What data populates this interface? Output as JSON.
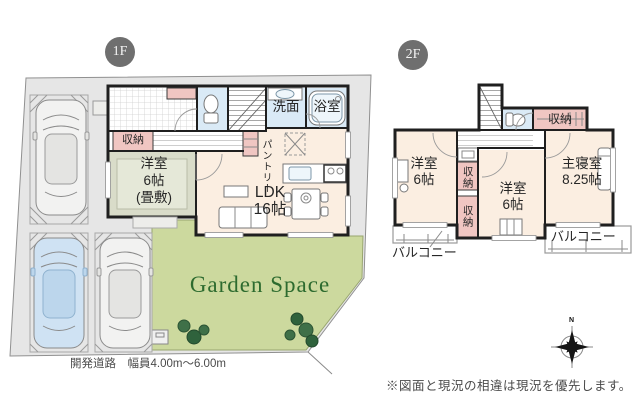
{
  "palette": {
    "wall": "#1f1f1f",
    "room-cream": "#fbeee1",
    "closet-pink": "#f0c6c2",
    "wet-blue": "#daeaf6",
    "tatami-green": "#d9dcc9",
    "tatami-inner": "#e5e8d8",
    "garden-green": "#ccd99e",
    "lot-gray": "#e6e6e6",
    "garden-text": "#2d6b2f",
    "badge": "#6f6f6f",
    "car-blue": "#cfe2f3"
  },
  "floor1": {
    "badge": "1F",
    "closet": "収納",
    "tatami_room": {
      "line1": "洋室",
      "line2": "6帖",
      "line3": "(畳敷)"
    },
    "ldk": {
      "line1": "LDK",
      "line2": "16帖"
    },
    "washroom": "洗面",
    "bathroom": "浴室",
    "pantry": "パントリー",
    "garden": "Garden Space",
    "road": "開発道路　幅員4.00m〜6.00m"
  },
  "floor2": {
    "badge": "2F",
    "bedroom_left": {
      "line1": "洋室",
      "line2": "6帖"
    },
    "closet_top": "収納",
    "closet_mid": "収納",
    "closet_bottom": "収納",
    "bedroom_center": {
      "line1": "洋室",
      "line2": "6帖"
    },
    "master_bedroom": {
      "line1": "主寝室",
      "line2": "8.25帖"
    },
    "balcony_left": "バルコニー",
    "balcony_right": "バルコニー"
  },
  "compass": {
    "north": "N"
  },
  "footer": {
    "disclaimer": "※図面と現況の相違は現況を優先します。"
  }
}
